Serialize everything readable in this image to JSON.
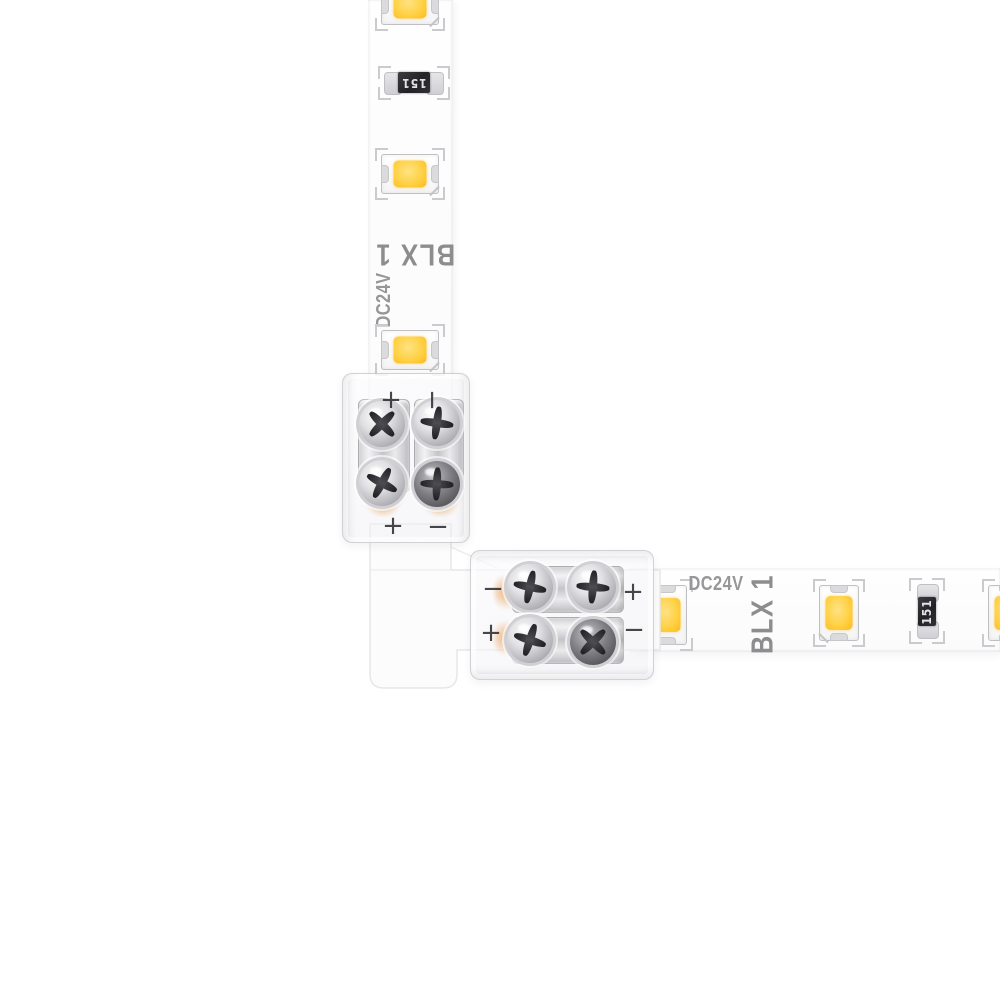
{
  "product": {
    "brand_label": "BLX 1",
    "voltage_label": "DC24V",
    "resistor_code": "151",
    "plus_mark": "+",
    "minus_mark": "−"
  },
  "colors": {
    "background": "#FFFFFF",
    "strip_white": "#FDFDFD",
    "led_phosphor_yellow": "#FFD145",
    "led_phosphor_deep": "#FCBA1E",
    "print_gray": "#8D8D90",
    "polarity_dark": "#2E2E31",
    "resistor_body_black": "#28282C",
    "terminal_silver": "#D4D4D7",
    "copper_accent": "#E99C52"
  }
}
